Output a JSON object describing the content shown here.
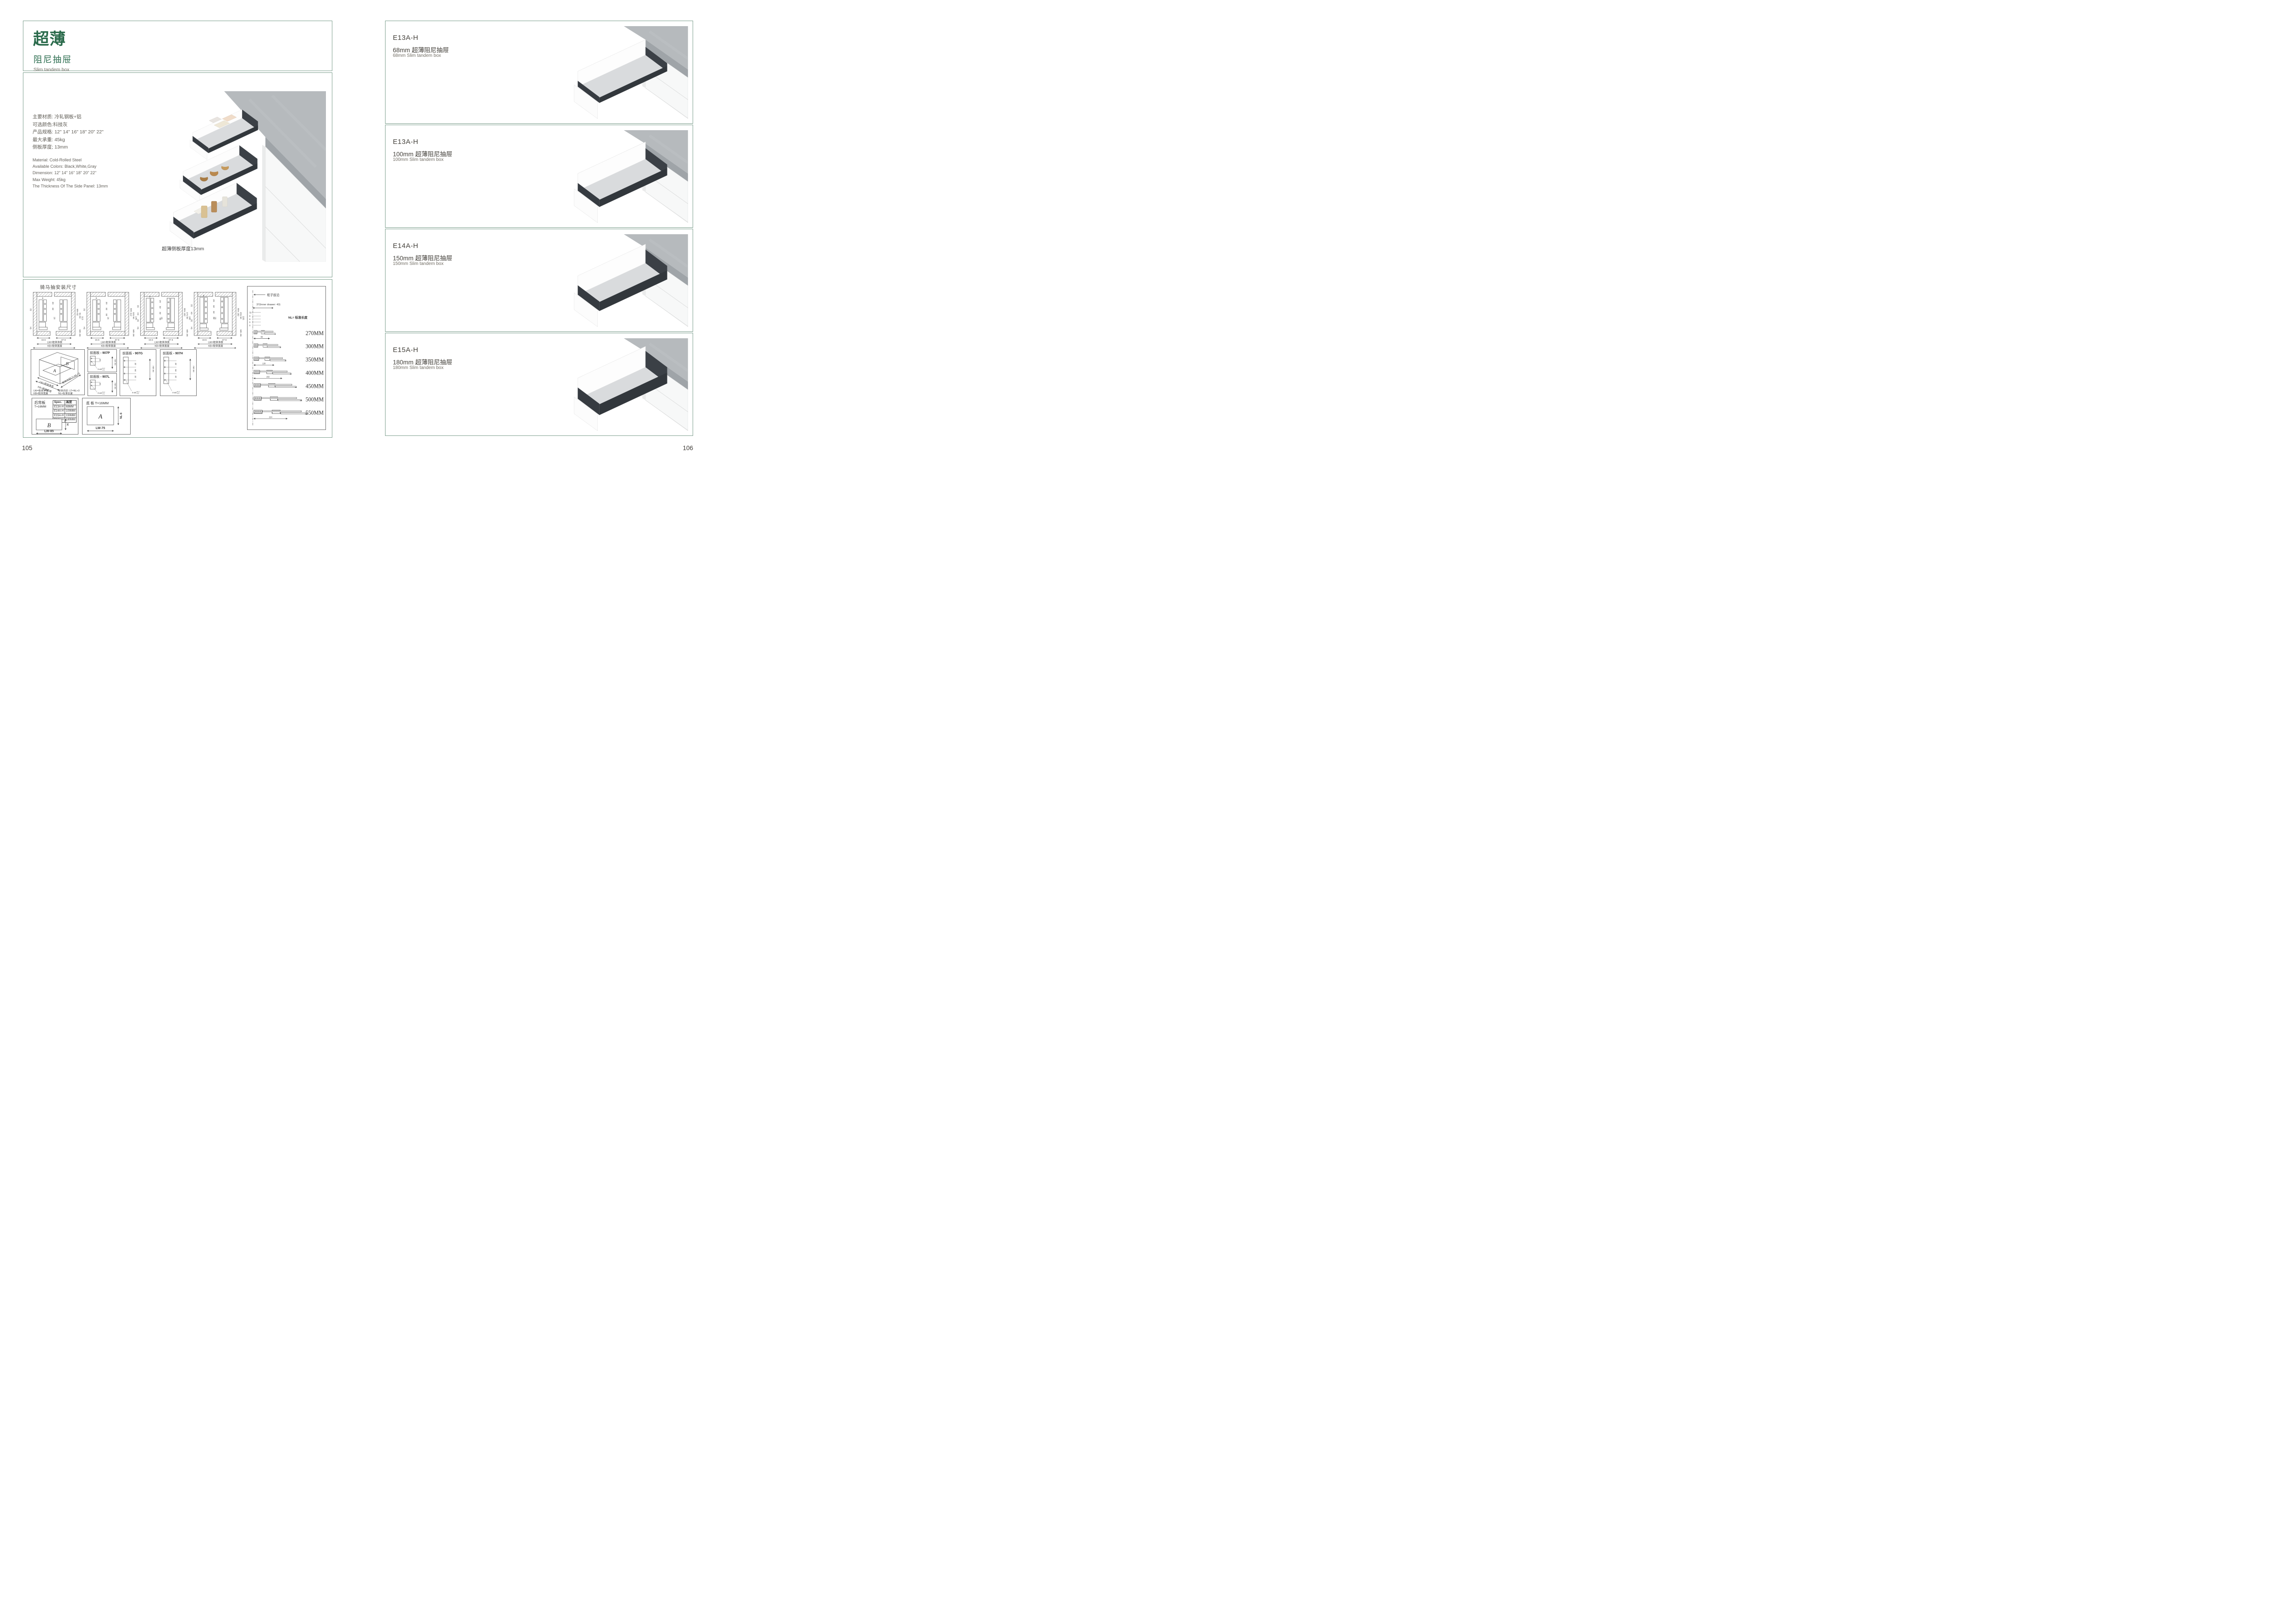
{
  "colors": {
    "accent_green": "#2a6a4b",
    "box_border": "#7d9f8e",
    "ink": "#45423c",
    "gray_text": "#716d64",
    "drawing_line": "#4d4d4d",
    "rail_dark": "#3b4046",
    "counter_gray": "#b6babd"
  },
  "left_page": {
    "page_number": "105",
    "header": {
      "title_cn": "超薄",
      "subtitle_cn": "阻尼抽屉",
      "subtitle_en": "Slim tandem box"
    },
    "specs_cn": [
      "主要材质: 冷轧钢板+铝",
      "可选颜色:科技灰",
      "产品规格: 12\" 14\" 16\" 18\" 20\" 22\"",
      "最大承重: 45kg",
      "侧板厚度; 13mm"
    ],
    "specs_en": [
      "Material: Cold-Rolled Steel",
      "Available Colors: Black,White,Gray",
      "Dimension: 12\" 14\" 16\" 18\" 20\" 22\"",
      "Max Weight: 45kg",
      "The Thickness Of The Side Panel: 13mm"
    ],
    "photo_caption": "超薄侧板厚度13mm",
    "install": {
      "title": "骑马抽安装尺寸",
      "sections": [
        {
          "t9": "9",
          "t20": "20",
          "p1": "32",
          "l1": "32",
          "l3": "54",
          "mid": "16",
          "r1": "Min 82",
          "r2": "91.50",
          "r3": "113",
          "rb": "Min 36",
          "b1": "16.5",
          "b2": "37.5",
          "lw": "LW=柜体净宽",
          "kb": "KB=柜体宽度"
        },
        {
          "t9": "9",
          "t20": "20",
          "p1": "32",
          "p2": "32",
          "l1": "32",
          "l3": "54",
          "mid": "16",
          "r1": "Min 112",
          "r2": "121.50",
          "r3": "145",
          "rb": "Min 36",
          "b1": "16.5",
          "b2": "37.5",
          "lw": "LW=柜体净宽",
          "kb": "KB=柜体宽度"
        },
        {
          "t9": "9",
          "t20": "20",
          "p1": "32",
          "p2": "32",
          "p3": "32",
          "l1": "32",
          "l2": "64",
          "l25": "32",
          "l3": "54",
          "mid": "16",
          "r1": "Min 162",
          "r2": "171.50",
          "r3": "195",
          "rb": "Min 36",
          "b1": "16.5",
          "b2": "37.5",
          "lw": "LW=柜体净宽",
          "kb": "KB=柜体宽度"
        },
        {
          "t9": "9",
          "t20": "20",
          "p1": "32",
          "p2": "32",
          "p3": "32",
          "l1": "32",
          "l2": "64",
          "l25": "32",
          "l3": "54",
          "mid": "16",
          "r1": "Min 192",
          "r2": "201.50",
          "r3": "225",
          "rb": "Min 36",
          "b1": "16.5",
          "b2": "37.5",
          "lw": "LW=柜体净宽",
          "kb": "KB=柜体宽度"
        }
      ],
      "iso": {
        "panel_a": "A",
        "panel_b": "B",
        "lw_arrow": "LW=柜体净宽",
        "kb_arrow": "KB=柜体宽度",
        "lt_diag": "柜体内空LT=NL+3",
        "legend1": "LW=柜体净宽",
        "legend2": "KB=柜体宽度",
        "legend3": "柜体内空: LT=NL+3",
        "legend4": "NL=标准长度"
      },
      "front_panels": [
        {
          "name": "前面板",
          "code": "- 907P",
          "d1": "32",
          "min": "min 54",
          "note": "2-ø2",
          "tt": "+0.2",
          "tb": "-0.1"
        },
        {
          "name": "前面板",
          "code": "- 907L",
          "d1": "32",
          "min": "min 54",
          "note": "2-ø2",
          "tt": "+0.2",
          "tb": "-0.1"
        },
        {
          "name": "前面板",
          "code": "- 907G",
          "d1": "32",
          "d2": "64",
          "d3": "32",
          "min": "min 54",
          "note": "4-ø2",
          "tt": "+0.2",
          "tb": "-0.1"
        },
        {
          "name": "前面板",
          "code": "- 907H",
          "d1": "32",
          "d2": "64",
          "d3": "32",
          "min": "min 54",
          "note": "4-ø2",
          "tt": "+0.2",
          "tb": "-0.1"
        }
      ],
      "back_panel": {
        "title": "后背板",
        "thick": "T=16MM",
        "col1": "Spec.",
        "col2": "高度",
        "rows": [
          [
            "E13A-H",
            "68MM"
          ],
          [
            "E14A-H",
            "100MM"
          ],
          [
            "E15A-H",
            "150MM"
          ],
          [
            "E16A-H",
            "180MM"
          ]
        ],
        "letter": "B",
        "h_label": "H",
        "w_label": "LW-85"
      },
      "bottom_panel": {
        "title": "底 板 T=16MM",
        "letter": "A",
        "d_label": "NL-6",
        "w_label": "LW-75"
      },
      "chart": {
        "front_edge": "柜子前沿",
        "offset": "37(Inner drawer: 43)",
        "d32": "32",
        "d9a": "9",
        "d9b": "9",
        "d9c": "9",
        "d9d": "9",
        "nl_note": "NL= 标准长度",
        "rows": [
          {
            "len": "270MM",
            "dim": "96"
          },
          {
            "len": "300MM",
            "dim": ""
          },
          {
            "len": "350MM",
            "dim": "128"
          },
          {
            "len": "400MM",
            "dim": "192"
          },
          {
            "len": "450MM",
            "dim": ""
          },
          {
            "len": "500MM",
            "dim": ""
          },
          {
            "len": "550MM",
            "dim": "224"
          }
        ]
      }
    }
  },
  "right_page": {
    "page_number": "106",
    "sections": [
      {
        "code": "E13A-H",
        "title_cn": "68mm 超薄阻尼抽屉",
        "title_en": "68mm Slim tandem box"
      },
      {
        "code": "E13A-H",
        "title_cn": "100mm 超薄阻尼抽屉",
        "title_en": "100mm Slim tandem box"
      },
      {
        "code": "E14A-H",
        "title_cn": "150mm 超薄阻尼抽屉",
        "title_en": "150mm Slim tandem box"
      },
      {
        "code": "E15A-H",
        "title_cn": "180mm 超薄阻尼抽屉",
        "title_en": "180mm Slim tandem box"
      }
    ]
  }
}
